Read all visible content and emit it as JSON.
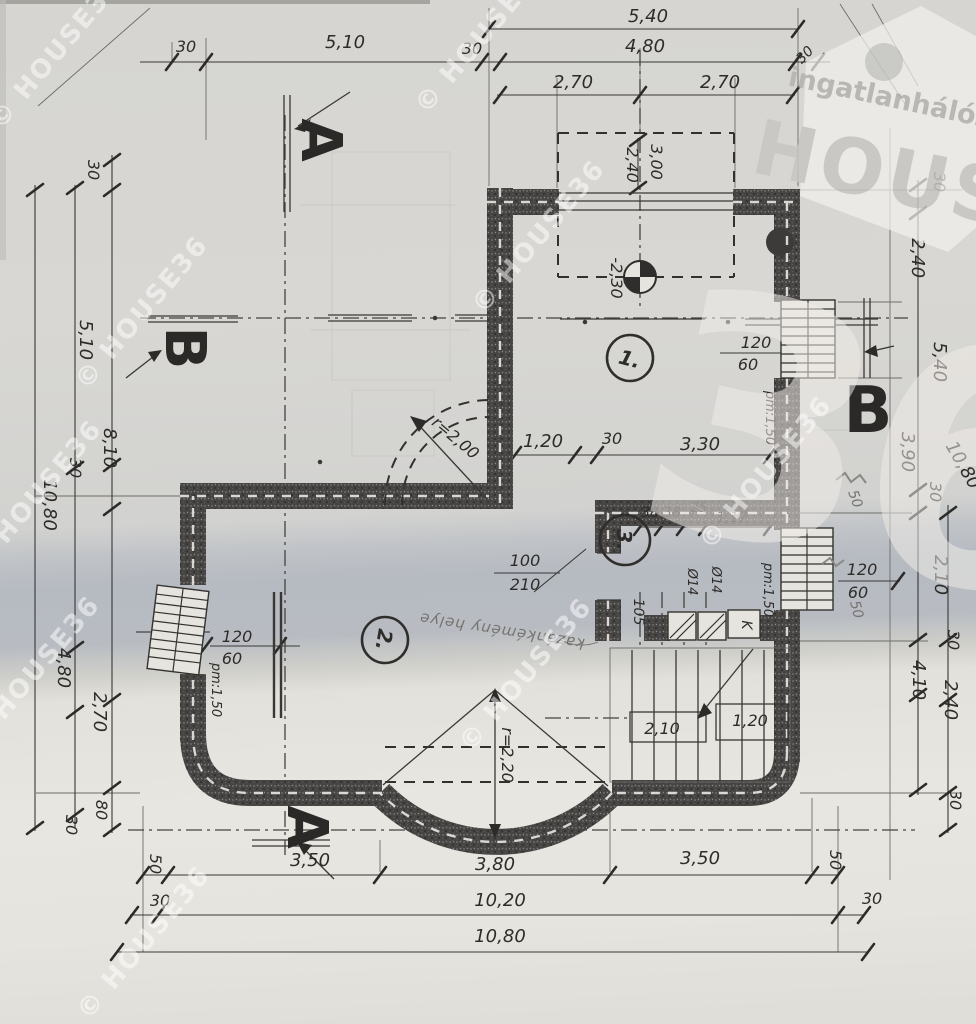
{
  "watermarks": {
    "copyright": "© HOUSE36",
    "logo": {
      "line1": "ingatlanhálózat",
      "line2": "HOUSE",
      "number": "36"
    }
  },
  "section_markers": {
    "a_top": "A",
    "a_bottom": "A",
    "b_left": "B",
    "b_right": "B"
  },
  "rooms": {
    "r1": "1.",
    "r2": "2.",
    "r3": "3."
  },
  "dims_top": {
    "overall": "5,40",
    "wall_l": "30",
    "span_l": "5,10",
    "wall_m": "30",
    "span_r": "4,80",
    "wall_r": "30",
    "half_l": "2,70",
    "half_r": "2,70"
  },
  "dims_left": {
    "wall_top": "30",
    "span_top": "5,10",
    "wall_mid": "30",
    "span_inner": "8,10",
    "overall": "10,80",
    "span_low": "4,80",
    "span_low2": "2,70",
    "seg": "80",
    "wall_bot": "30"
  },
  "dims_right": {
    "wall_top": "30",
    "span_a": "2,40",
    "span_b": "5,40",
    "span_c": "3,90",
    "wall_a": "30",
    "overall": "10,80",
    "span_d": "2,10",
    "wall_b": "30",
    "span_e": "2,40",
    "span_f": "4,10",
    "wall_c": "30"
  },
  "dims_bottom": {
    "end_l": "50",
    "span_l": "3,50",
    "span_m": "3,80",
    "span_r": "3,50",
    "end_r": "50",
    "wall_l": "30",
    "span_total": "10,20",
    "wall_r": "30",
    "overall": "10,80"
  },
  "dims_interior": {
    "room1_a": "1,20",
    "room1_b": "30",
    "room1_c": "3,30",
    "terrace_w": "3,00",
    "terrace_d": "2,40",
    "level": "-2,30",
    "room3_a": "38",
    "room3_b": "38",
    "room3_c": "25",
    "room3_d": "1,17",
    "flue1": "Ø14",
    "flue2": "Ø14",
    "room3_e": "105",
    "room3_pm": "pm:1,50",
    "door_w": "100",
    "door_h": "210",
    "win_left_w": "120",
    "win_left_h": "60",
    "win_left_pm": "pm:1,50",
    "win_right_w": "120",
    "win_right_h": "60",
    "win_right_pm": "pm:1,50",
    "win_right2_w": "120",
    "win_right2_h": "60",
    "radius_wall": "r=2,00",
    "radius_bay": "r=2,20",
    "stair_a": "2,10",
    "stair_b": "1,20"
  },
  "annotations": {
    "flue_box": "K",
    "note": "kazánkémény helye",
    "pencil_a": "50",
    "pencil_b": "50"
  }
}
